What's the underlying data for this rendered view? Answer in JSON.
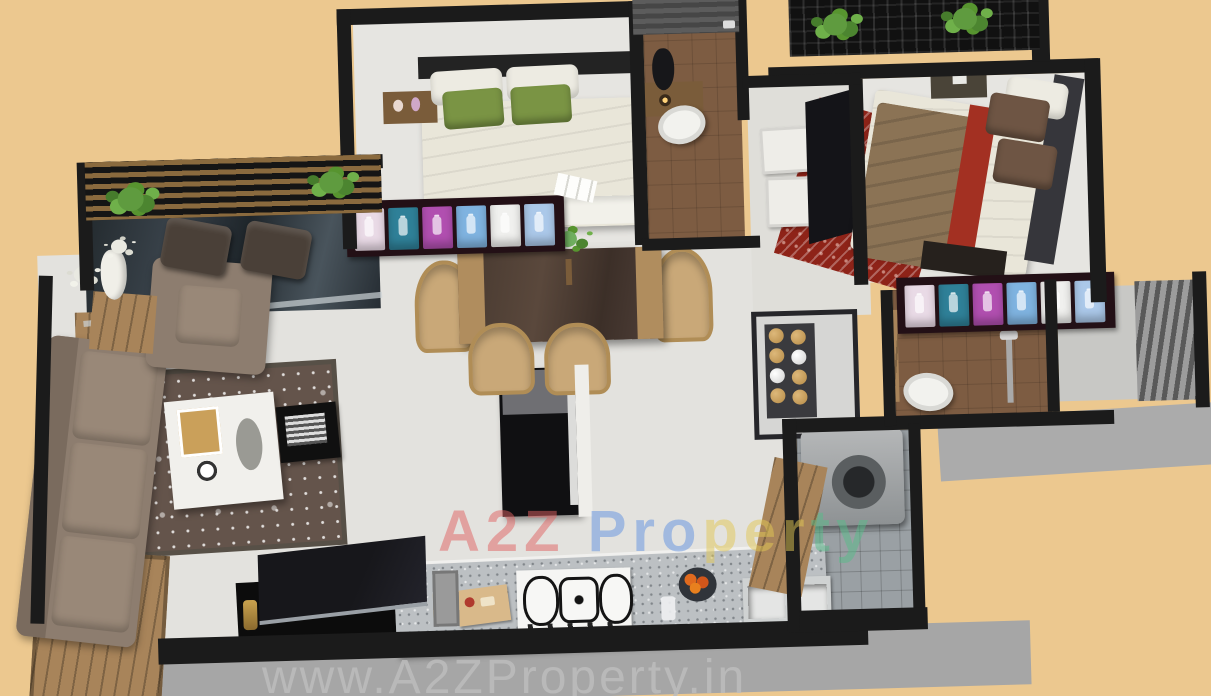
{
  "scene": {
    "type": "3d-isometric-floorplan-render",
    "background_color": "#ecc88f",
    "rooms_depicted": [
      "balcony-sitout",
      "living-room",
      "entry-deck",
      "dining-area",
      "kitchen",
      "bedroom-1",
      "bathroom-1",
      "bedroom-2",
      "bathroom-2",
      "utility-area",
      "louver-ledge"
    ]
  },
  "watermarks": {
    "center": {
      "segments": [
        {
          "text": "A2Z ",
          "color": "#e06262"
        },
        {
          "text": "Pro",
          "color": "#6292e0"
        },
        {
          "text": "per",
          "color": "#e2c855"
        },
        {
          "text": "ty",
          "color": "#58bd8a"
        }
      ]
    },
    "bottom": {
      "text": "www.A2ZProperty.in",
      "color": "#bdbdbd"
    }
  },
  "palette": {
    "wall": "#1b1b1b",
    "floor_light": "#e6e5e1",
    "tile_brown": "#7d5c42",
    "wood": "#a8845a",
    "sofa_taupe": "#8d7d6f",
    "rug_living": "#64544b",
    "rug_red": "#8e2318",
    "pillow_green": "#7a9444",
    "blanket_brown": "#8b7355",
    "accent_red": "#a33022",
    "balcony_glass": "#2c3236",
    "counter_gray": "#bcc0c3",
    "slab_gray": "#a6a6a6",
    "plant_green": "#5f9b3f",
    "wardrobe_cells": [
      "#e9dae6",
      "#2f8098",
      "#b14fb0",
      "#7fb3e0",
      "#f0f0ee",
      "#abc8e9"
    ]
  }
}
